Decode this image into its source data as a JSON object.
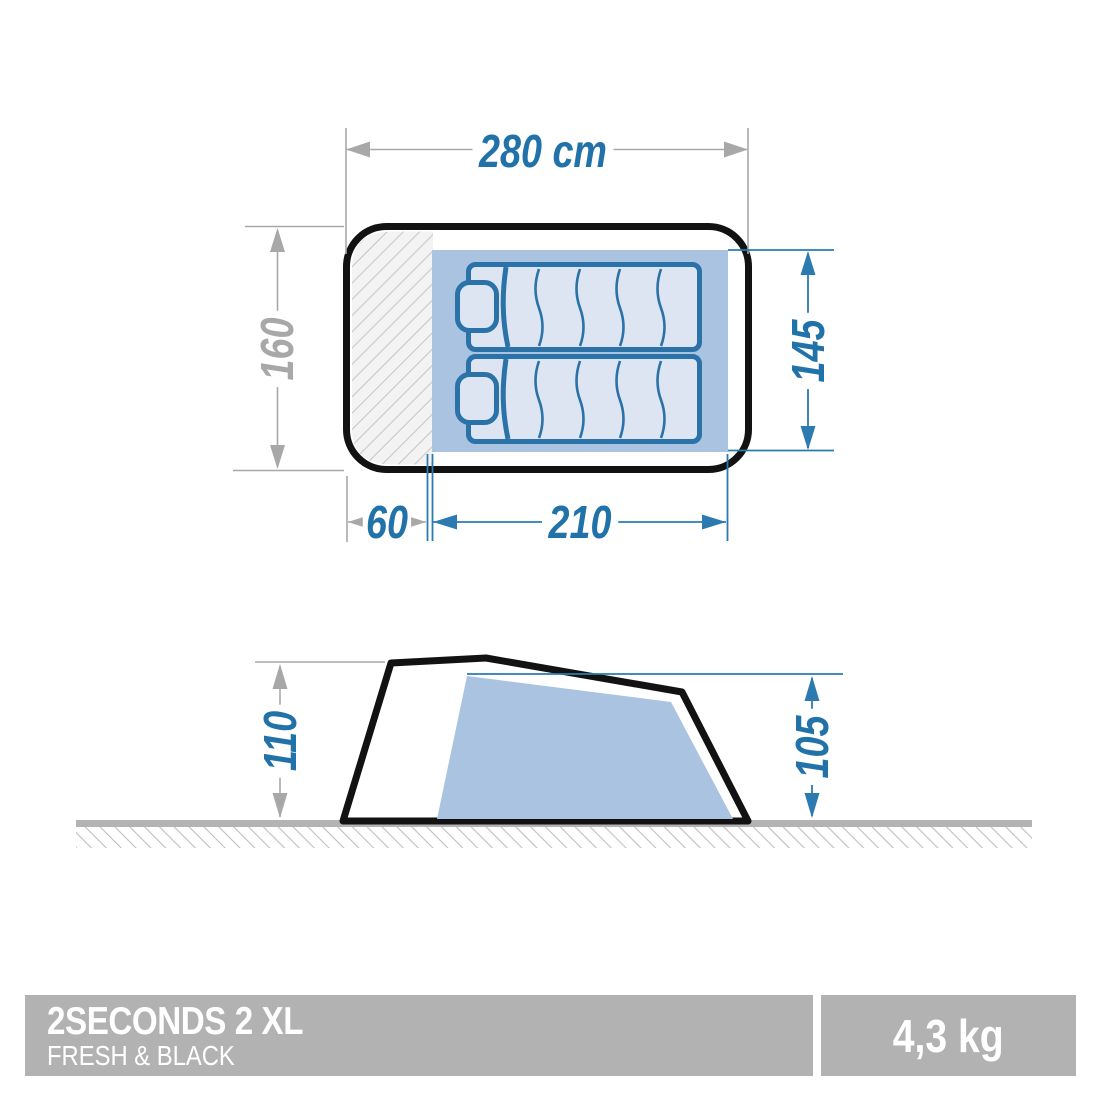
{
  "product": {
    "name": "2SECONDS 2 XL",
    "range": "FRESH & BLACK",
    "weight": "4,3 kg"
  },
  "top_view": {
    "overall_width_label": "280 cm",
    "overall_depth_label": "160",
    "bedroom_depth_label": "145",
    "porch_width_label": "60",
    "bedroom_width_label": "210",
    "sleeping_spots": 2
  },
  "side_view": {
    "outer_height_label": "110",
    "inner_height_label": "105"
  },
  "colors": {
    "dimension_blue": "#2172a8",
    "dimension_gray": "#a8a8a8",
    "floor_blue": "#a9c3e1",
    "sleeping_bag_fill": "#dce5f1",
    "tent_outline": "#121212",
    "bar_gray": "#b2b2b2",
    "ground_gray": "#b3b3b3",
    "hatch_gray": "#c8c8c8"
  }
}
